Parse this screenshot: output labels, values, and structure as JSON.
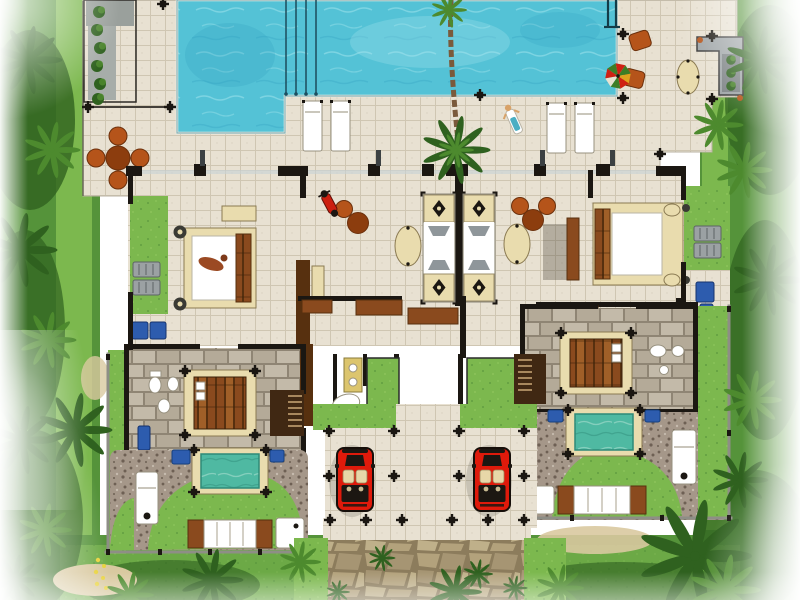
{
  "scene": {
    "description": "Top-down architectural site plan rendering of a twin pool villa: one shared L-shaped turquoise swimming pool with four lane ropes and ladder, tiled pool deck with white sun loungers, round terracotta dining sets, outdoor kitchen counter and parasol, two poolside bedroom suites with canopy beds and private side gardens, a central open-air sala with twin ornamented daybeds and oval side tables, two timber-floored master suites each with stair, bathroom fixtures and a private teal plunge pool, gravel courtyards with massage tables and timber-ended day beds, twin carports with red convertible cars, a central tiled walkway leading to a flagstone entry path, all surrounded by tropical palm landscaping fading to white at the edges.",
    "objects": {
      "swimming_pools": 1,
      "plunge_pools": 2,
      "cars": 2,
      "bedroom_suites": 4,
      "lane_ropes": 4
    }
  },
  "palette": {
    "deck": "#e8e1d2",
    "deck_line": "#cfc6b2",
    "wall": "#1b1712",
    "glass": "#c9d3d5",
    "fin": "#3c4143",
    "water": "#54c2d6",
    "water_light": "#a5e6ee",
    "water_deep": "#2f9fc0",
    "plunge": "#4fb9a2",
    "plunge_light": "#a8ddcf",
    "plunge_dark": "#2e8a78",
    "grass": "#7cb84e",
    "grass_light": "#95cc62",
    "grass_dark": "#55933a",
    "foliage": "#2f611f",
    "foliage_light": "#4d8a2e",
    "stone": "#b4aa98",
    "stone_light": "#c3baa9",
    "stone_joint": "#8f8574",
    "wood": "#8a4a1e",
    "wood_light": "#a05f28",
    "wood_dark": "#57300f",
    "terracotta": "#b5541a",
    "terracotta_dark": "#8c3d0e",
    "gravel": "#a59789",
    "gravel_dark": "#6e6054",
    "gravel_light": "#c6bbae",
    "cream": "#e9dcae",
    "cream_dark": "#d6c68e",
    "vanity": "#dcc56e",
    "blue": "#2d5cae",
    "gray_furniture": "#9ba1a3",
    "gray_counter": "#9fa5a7",
    "fence": "#8e8e86",
    "car_red": "#df1a0b",
    "car_black": "#1c1712",
    "car_seat": "#e7d7a8",
    "white": "#ffffff",
    "sand": "#d9c9a0",
    "flower_yellow": "#e8d23a",
    "path_joint": "#8c7c5c",
    "path_stone": "#b3a27c",
    "path_stone2": "#a69573",
    "path_stone3": "#bfb08a",
    "trunk": "#7a5a3b",
    "shadow": "#3a352c",
    "skin": "#d8a268",
    "towel_teal": "#2aa0b8",
    "figure_brown": "#9b4a23"
  }
}
